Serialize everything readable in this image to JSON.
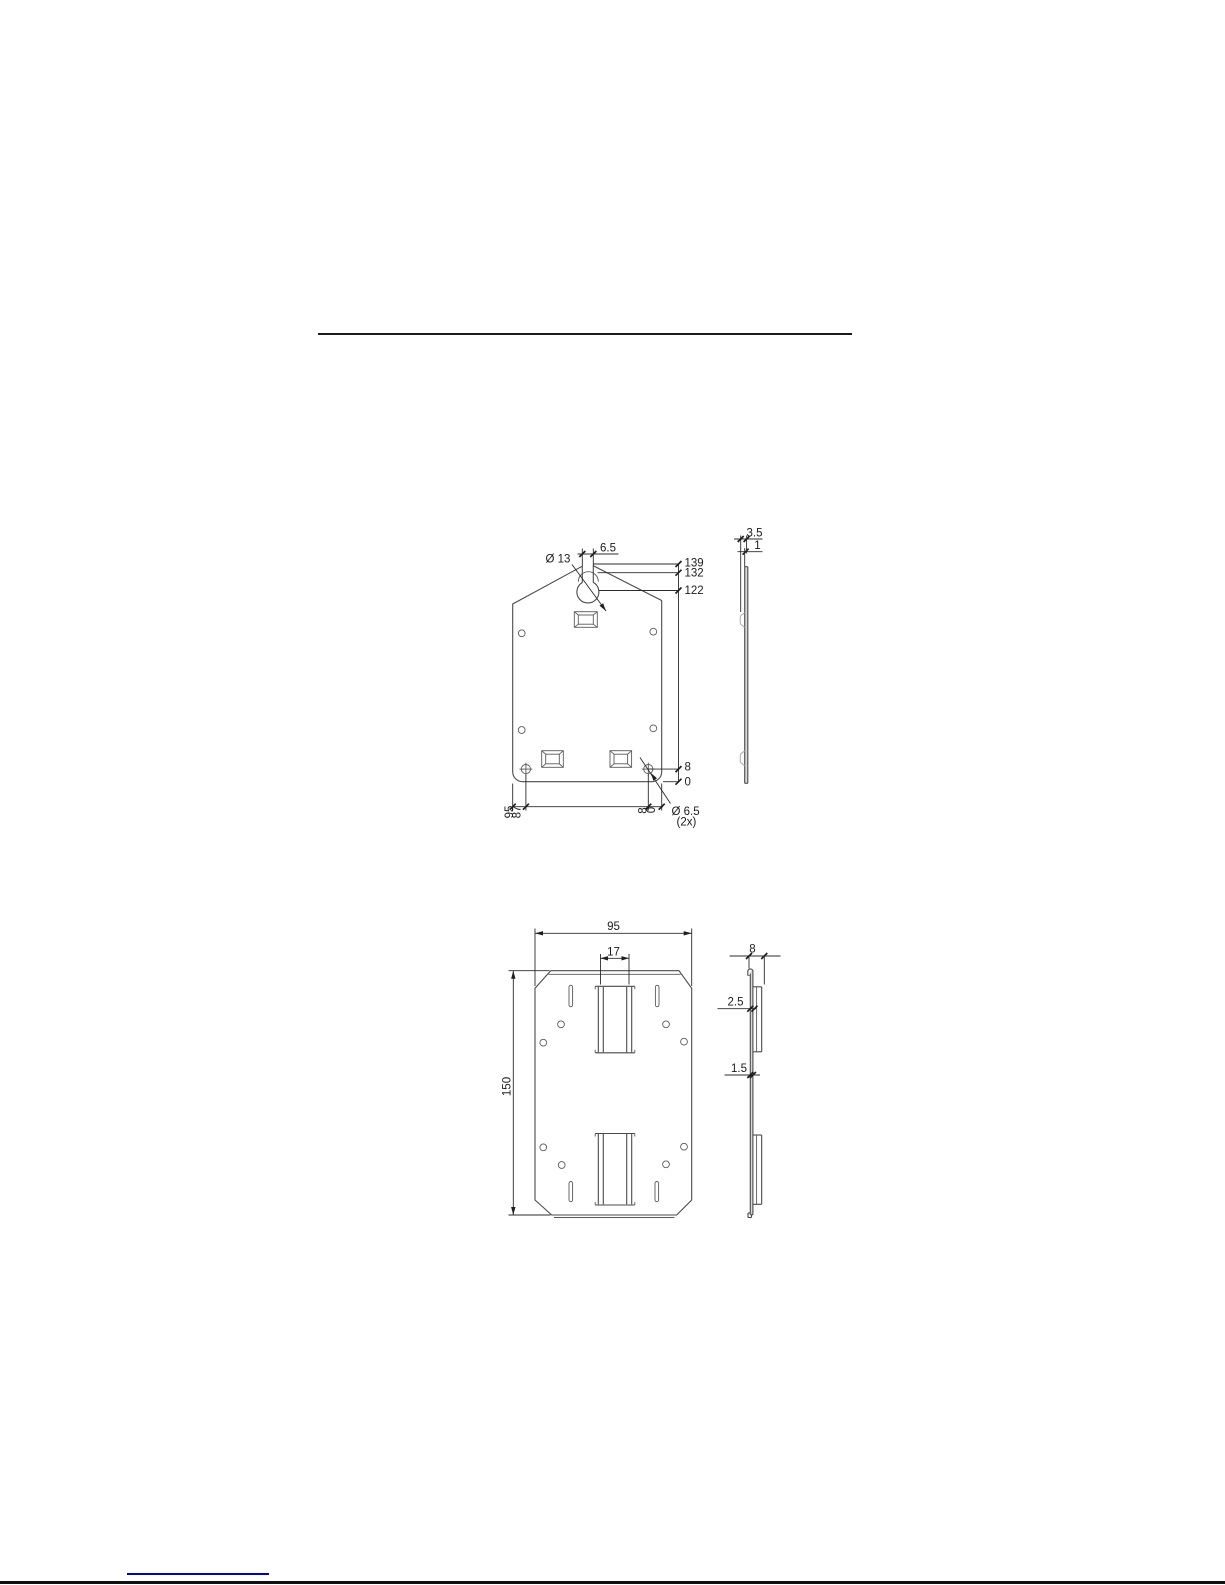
{
  "drawing1": {
    "front": {
      "slot_width": "6.5",
      "keyhole_diameter": "Ø 13",
      "level_top": "139",
      "level_slot_bottom": "132",
      "level_hole_center": "122",
      "level_bottom_hole": "8",
      "level_zero": "0",
      "width_full": "95",
      "width_hole": "87",
      "width_hole_right": "8",
      "width_zero": "0",
      "bottom_hole_diameter": "Ø 6.5",
      "bottom_hole_count": "(2x)"
    },
    "side": {
      "emboss_depth": "3.5",
      "material_thickness": "1"
    }
  },
  "drawing2": {
    "front": {
      "plate_width": "95",
      "rail_width": "17",
      "plate_height": "150"
    },
    "side": {
      "rail_depth": "8",
      "rail_offset": "2.5",
      "material_thickness": "1.5"
    }
  }
}
